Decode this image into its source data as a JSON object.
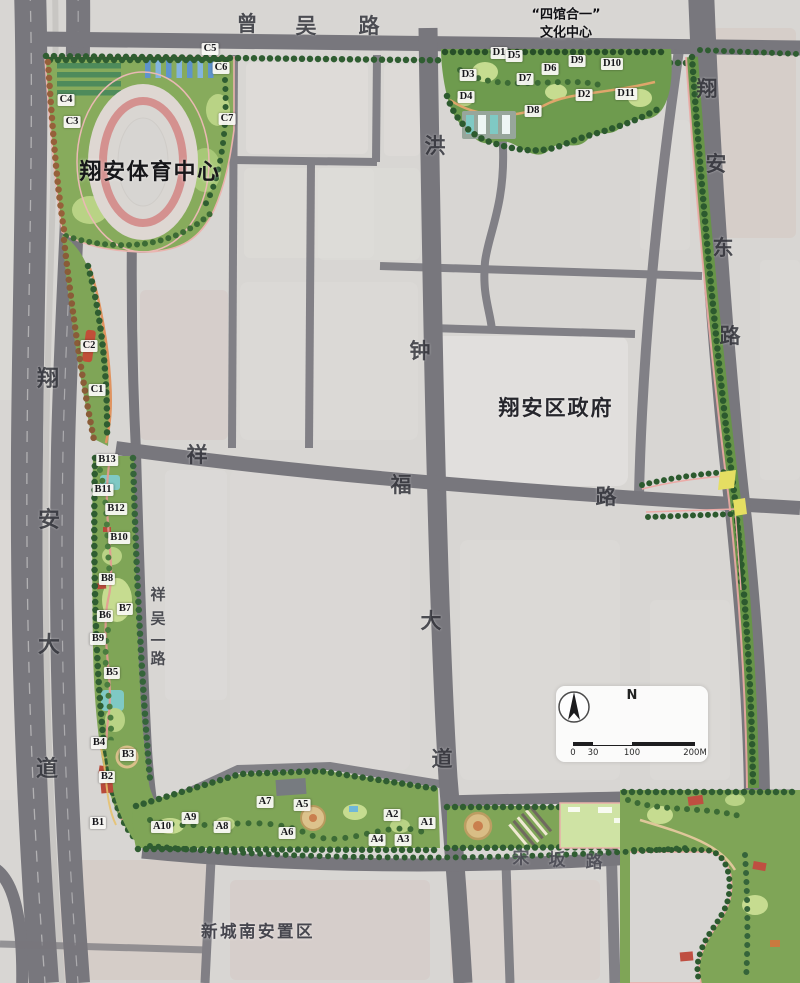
{
  "map": {
    "landmarks": [
      {
        "name": "sports-center-label",
        "text": "翔安体育中心",
        "x": 150,
        "y": 170,
        "cls": "landmark-xl"
      },
      {
        "name": "culture-center-label",
        "text": "“四馆合一”\n文化中心",
        "x": 566,
        "y": 24,
        "cls": "landmark-sm"
      },
      {
        "name": "district-government-label",
        "text": "翔安区政府",
        "x": 556,
        "y": 407,
        "cls": "landmark-lg"
      },
      {
        "name": "resettlement-area-label",
        "text": "新城南安置区",
        "x": 258,
        "y": 930,
        "cls": "landmark-md"
      }
    ],
    "road_labels": [
      {
        "name": "road-zengwu",
        "road": "曾吴路",
        "size": 21,
        "chars": [
          {
            "c": "曾",
            "x": 247,
            "y": 23
          },
          {
            "c": "吴",
            "x": 306,
            "y": 25
          },
          {
            "c": "路",
            "x": 369,
            "y": 25
          }
        ]
      },
      {
        "name": "road-xiangan-avenue",
        "road": "翔安大道",
        "size": 22,
        "chars": [
          {
            "c": "翔",
            "x": 48,
            "y": 377
          },
          {
            "c": "安",
            "x": 49,
            "y": 518
          },
          {
            "c": "大",
            "x": 49,
            "y": 643
          },
          {
            "c": "道",
            "x": 47,
            "y": 767
          }
        ]
      },
      {
        "name": "road-xiangan-east",
        "road": "翔安东路",
        "size": 21,
        "chars": [
          {
            "c": "翔",
            "x": 707,
            "y": 88
          },
          {
            "c": "安",
            "x": 716,
            "y": 163
          },
          {
            "c": "东",
            "x": 723,
            "y": 247
          },
          {
            "c": "路",
            "x": 730,
            "y": 335
          }
        ]
      },
      {
        "name": "road-hongzhong-avenue",
        "road": "洪钟大道",
        "size": 21,
        "chars": [
          {
            "c": "洪",
            "x": 435,
            "y": 145
          },
          {
            "c": "钟",
            "x": 420,
            "y": 350
          },
          {
            "c": "大",
            "x": 431,
            "y": 620
          },
          {
            "c": "道",
            "x": 442,
            "y": 758
          }
        ]
      },
      {
        "name": "road-xiangfu",
        "road": "祥福路",
        "size": 21,
        "chars": [
          {
            "c": "祥",
            "x": 197,
            "y": 454
          },
          {
            "c": "福",
            "x": 401,
            "y": 484
          },
          {
            "c": "路",
            "x": 606,
            "y": 496
          }
        ]
      },
      {
        "name": "road-xiangwu-first",
        "road": "祥吴一路",
        "size": 15,
        "chars": [
          {
            "c": "祥",
            "x": 158,
            "y": 594
          },
          {
            "c": "吴",
            "x": 158,
            "y": 618
          },
          {
            "c": "一",
            "x": 158,
            "y": 640
          },
          {
            "c": "路",
            "x": 158,
            "y": 658
          }
        ]
      },
      {
        "name": "road-songban",
        "road": "宋坂路",
        "size": 17,
        "color": "#4b4b54",
        "chars": [
          {
            "c": "宋",
            "x": 521,
            "y": 856
          },
          {
            "c": "坂",
            "x": 557,
            "y": 858
          },
          {
            "c": "路",
            "x": 594,
            "y": 860
          }
        ]
      }
    ],
    "zones": [
      {
        "group": "A",
        "markers": [
          {
            "label": "A1",
            "x": 427,
            "y": 823
          },
          {
            "label": "A2",
            "x": 392,
            "y": 815
          },
          {
            "label": "A3",
            "x": 403,
            "y": 840
          },
          {
            "label": "A4",
            "x": 377,
            "y": 840
          },
          {
            "label": "A5",
            "x": 302,
            "y": 805
          },
          {
            "label": "A6",
            "x": 287,
            "y": 833
          },
          {
            "label": "A7",
            "x": 265,
            "y": 802
          },
          {
            "label": "A8",
            "x": 222,
            "y": 827
          },
          {
            "label": "A9",
            "x": 190,
            "y": 818
          },
          {
            "label": "A10",
            "x": 162,
            "y": 827
          }
        ]
      },
      {
        "group": "B",
        "markers": [
          {
            "label": "B1",
            "x": 98,
            "y": 823
          },
          {
            "label": "B2",
            "x": 107,
            "y": 777
          },
          {
            "label": "B3",
            "x": 128,
            "y": 755
          },
          {
            "label": "B4",
            "x": 99,
            "y": 743
          },
          {
            "label": "B5",
            "x": 112,
            "y": 673
          },
          {
            "label": "B6",
            "x": 105,
            "y": 616
          },
          {
            "label": "B7",
            "x": 125,
            "y": 609
          },
          {
            "label": "B8",
            "x": 107,
            "y": 579
          },
          {
            "label": "B9",
            "x": 98,
            "y": 639
          },
          {
            "label": "B10",
            "x": 119,
            "y": 538
          },
          {
            "label": "B11",
            "x": 103,
            "y": 490
          },
          {
            "label": "B12",
            "x": 116,
            "y": 509
          },
          {
            "label": "B13",
            "x": 107,
            "y": 460
          }
        ]
      },
      {
        "group": "C",
        "markers": [
          {
            "label": "C1",
            "x": 97,
            "y": 390
          },
          {
            "label": "C2",
            "x": 89,
            "y": 346
          },
          {
            "label": "C3",
            "x": 72,
            "y": 122
          },
          {
            "label": "C4",
            "x": 66,
            "y": 100
          },
          {
            "label": "C5",
            "x": 210,
            "y": 49
          },
          {
            "label": "C6",
            "x": 221,
            "y": 68
          },
          {
            "label": "C7",
            "x": 227,
            "y": 119
          }
        ]
      },
      {
        "group": "D",
        "markers": [
          {
            "label": "D1",
            "x": 499,
            "y": 53
          },
          {
            "label": "D2",
            "x": 584,
            "y": 95
          },
          {
            "label": "D3",
            "x": 468,
            "y": 75
          },
          {
            "label": "D4",
            "x": 466,
            "y": 97
          },
          {
            "label": "D5",
            "x": 514,
            "y": 56
          },
          {
            "label": "D6",
            "x": 550,
            "y": 69
          },
          {
            "label": "D7",
            "x": 525,
            "y": 79
          },
          {
            "label": "D8",
            "x": 533,
            "y": 111
          },
          {
            "label": "D9",
            "x": 577,
            "y": 61
          },
          {
            "label": "D10",
            "x": 612,
            "y": 64
          },
          {
            "label": "D11",
            "x": 626,
            "y": 94
          }
        ]
      }
    ],
    "scale": {
      "north": "N",
      "ticks": [
        "0",
        "30",
        "100",
        "200M"
      ]
    },
    "colors": {
      "greenway": "#7fa557",
      "road": "#78777d",
      "water": "#7fc9c4",
      "accent_pink": "#ecaaa6",
      "track_pink": "#d4918f"
    }
  }
}
